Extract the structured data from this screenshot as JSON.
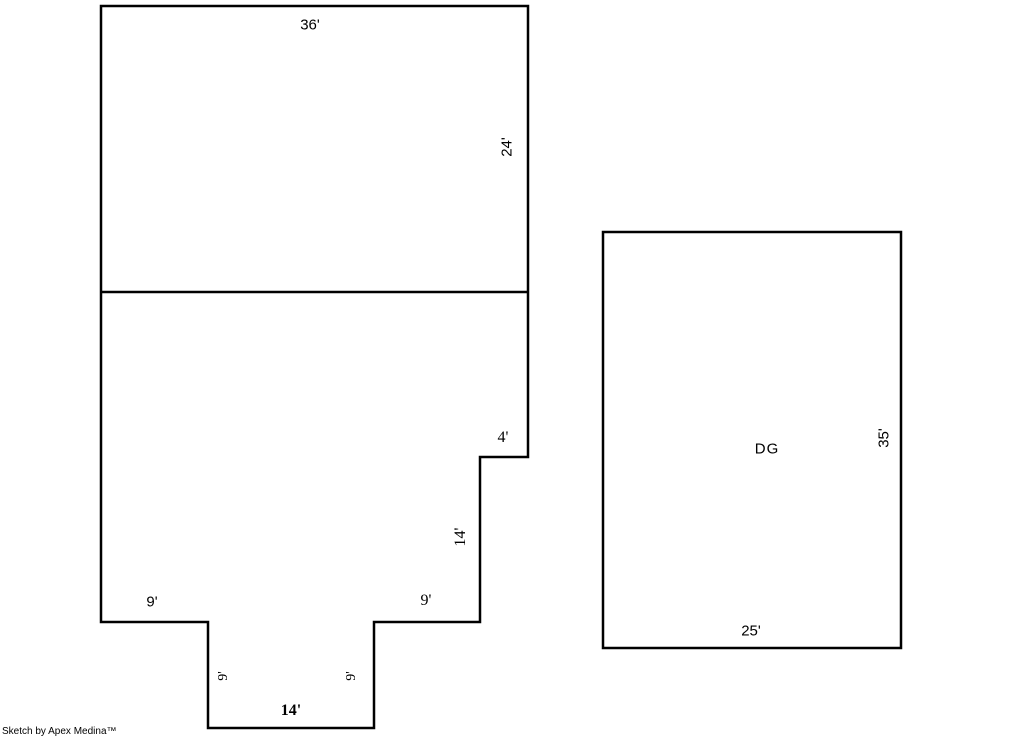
{
  "sketch": {
    "colors": {
      "line": "#000000",
      "background": "#ffffff"
    },
    "main_building": {
      "labels": {
        "top_width": "36'",
        "upper_right_height": "24'",
        "step": "4'",
        "lower_right_height": "14'",
        "left_shelf": "9'",
        "right_shelf": "9'",
        "notch_left": "9'",
        "notch_right": "9'",
        "bottom_width": "14'"
      }
    },
    "garage": {
      "name": "DG",
      "labels": {
        "right_height": "35'",
        "bottom_width": "25'"
      }
    }
  },
  "footer": {
    "credit": "Sketch by Apex Medina™"
  }
}
